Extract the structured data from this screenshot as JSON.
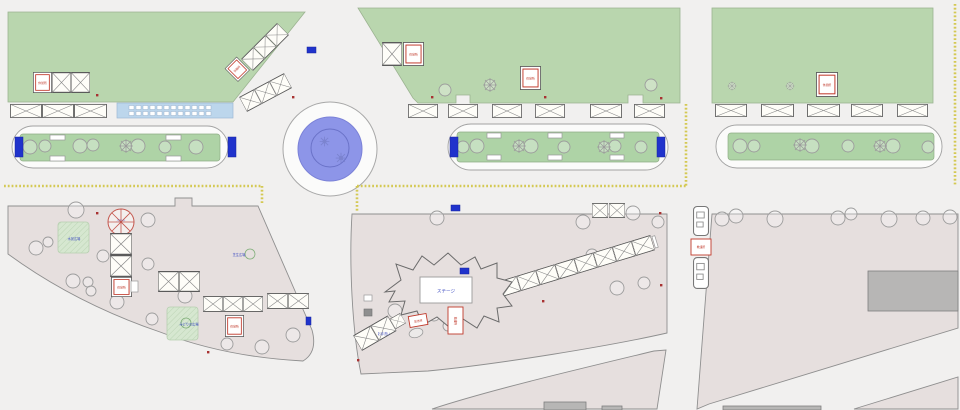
{
  "map": {
    "kind": "event-site-plan",
    "labels": {
      "stage": "ステージ",
      "rest_area": "休憩所",
      "first_aid": "救護所",
      "broadcast_seat": "放送席",
      "restroom": "お手洗い",
      "parasol": "パラソル",
      "plaza_water": "水景広場",
      "plaza_lawn": "芝生広場",
      "plaza_green": "みどりの広場"
    },
    "colors": {
      "road": "#f1f0ef",
      "park_green": "#b9d6ae",
      "median_green": "#aed3a6",
      "plaza_pink": "#e6dfde",
      "fountain_blue": "#8d95e8",
      "marker_blue": "#2033cc",
      "lane_yellow": "#d2c64a",
      "tent_red": "#c0392b",
      "label_blue": "#3a49c0",
      "building_gray": "#b7b6b5",
      "bus_bay_blue": "#bcd6ec"
    }
  }
}
